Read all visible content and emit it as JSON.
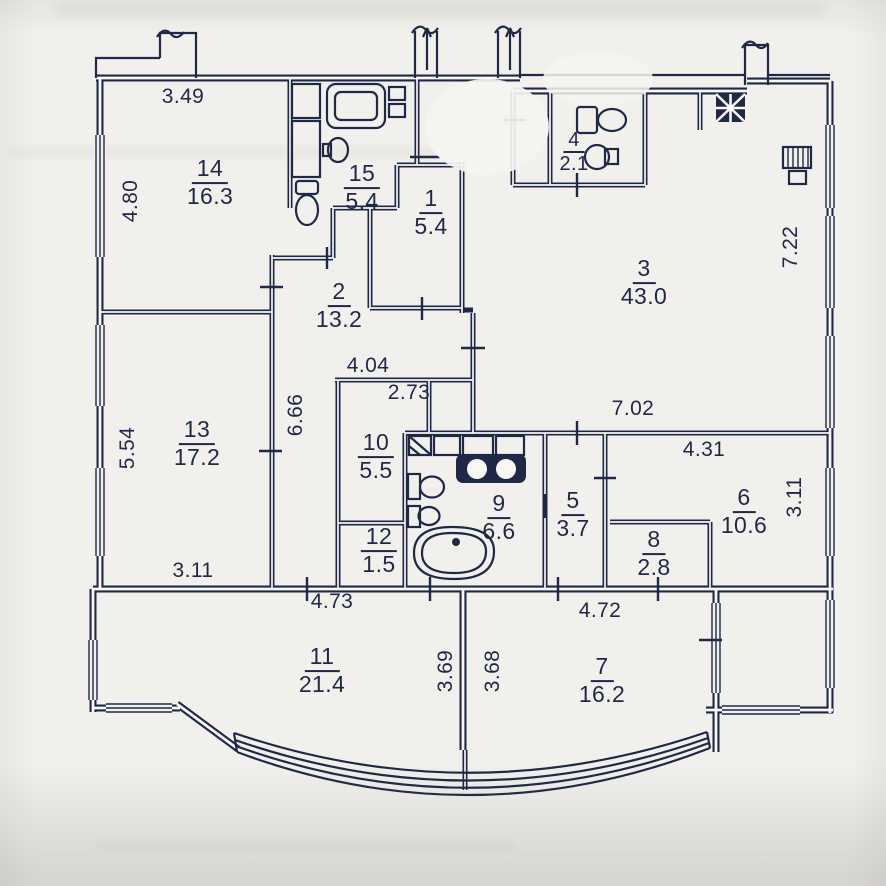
{
  "plan": {
    "title": "apartment-floor-plan",
    "colors": {
      "ink": "#1f2847",
      "paper": "#f1f0ec"
    },
    "rooms": {
      "r1": {
        "number": "1",
        "area": "5.4"
      },
      "r2": {
        "number": "2",
        "area": "13.2"
      },
      "r3": {
        "number": "3",
        "area": "43.0"
      },
      "r4": {
        "number": "4",
        "area": "2.1"
      },
      "r5": {
        "number": "5",
        "area": "3.7"
      },
      "r6": {
        "number": "6",
        "area": "10.6"
      },
      "r7": {
        "number": "7",
        "area": "16.2"
      },
      "r8": {
        "number": "8",
        "area": "2.8"
      },
      "r9": {
        "number": "9",
        "area": "6.6"
      },
      "r10": {
        "number": "10",
        "area": "5.5"
      },
      "r11": {
        "number": "11",
        "area": "21.4"
      },
      "r12": {
        "number": "12",
        "area": "1.5"
      },
      "r13": {
        "number": "13",
        "area": "17.2"
      },
      "r14": {
        "number": "14",
        "area": "16.3"
      },
      "r15": {
        "number": "15",
        "area": "5.4"
      }
    },
    "dimensions": {
      "room14_width": "3.49",
      "room14_height": "4.80",
      "room3_right_height": "7.22",
      "room13_height": "5.54",
      "corridor_height": "6.66",
      "hall_width": "4.04",
      "room10_width": "2.73",
      "room3_width": "7.02",
      "room6_width": "4.31",
      "room6_right_height": "3.11",
      "room13_width": "3.11",
      "room11_width": "4.73",
      "room7_width": "4.72",
      "room11_height": "3.69",
      "room7_height": "3.68"
    },
    "fixtures": [
      "bathtub-icon",
      "shower-tray-icon",
      "washing-machine-icon",
      "sink-icon",
      "toilet-icon",
      "bidet-icon",
      "double-sink-vanity-icon",
      "cabinet-icon",
      "vent-shaft-icon",
      "radiator-icon",
      "curved-glazing-icon"
    ]
  }
}
